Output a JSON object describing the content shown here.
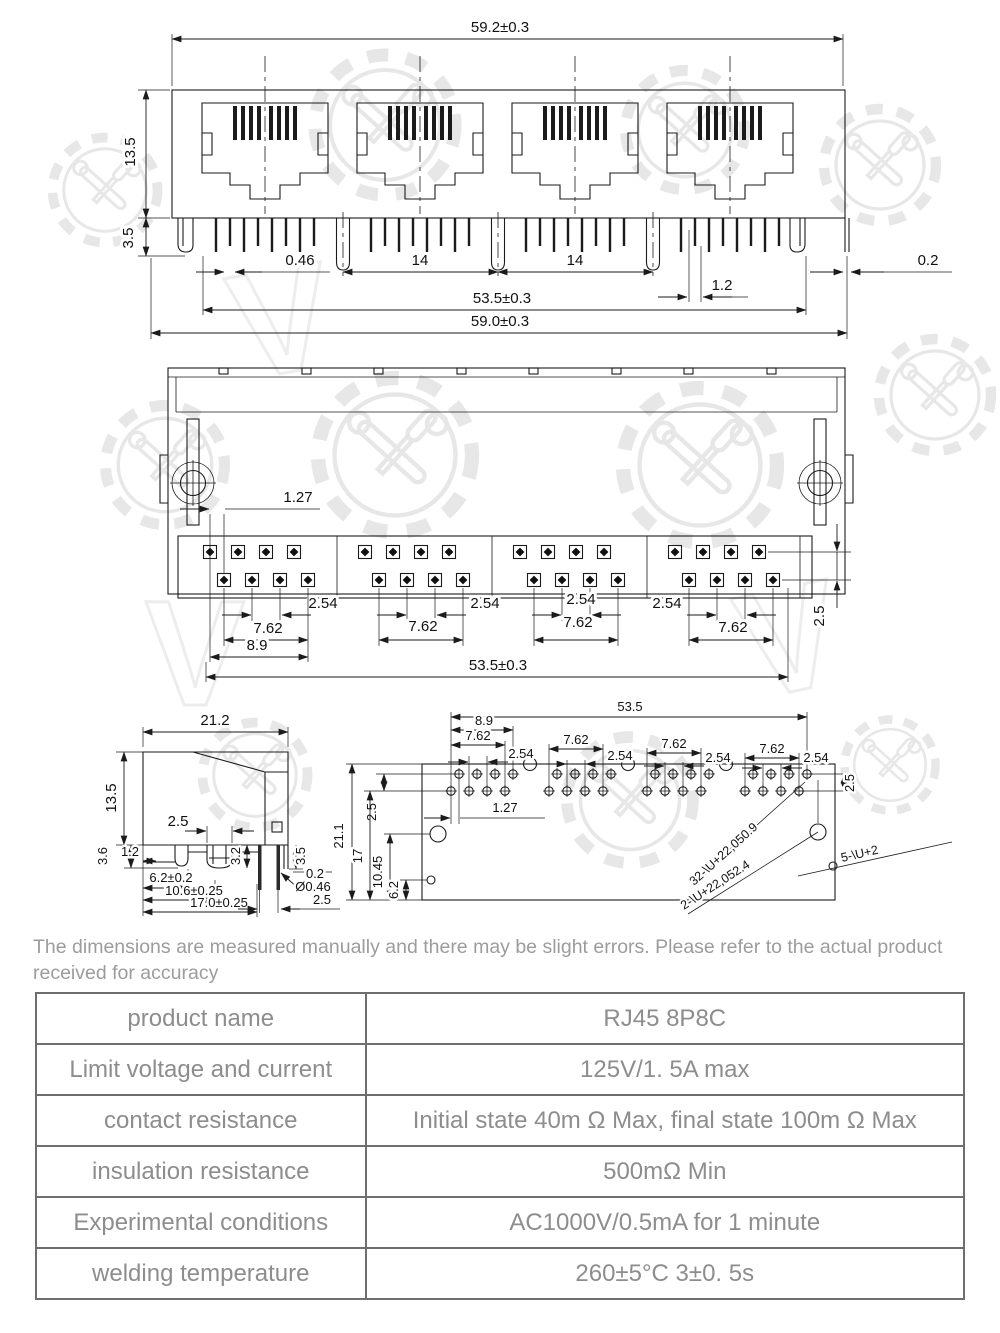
{
  "page": {
    "background": "#ffffff",
    "line_color": "#1b1b1b",
    "watermark_color": "#e7e7e7",
    "table_border_color": "#6e6e6e",
    "table_text_color": "#8d8d8d"
  },
  "watermark": {
    "logo": "gear-tools-logo",
    "letters": [
      "V",
      "V",
      "V",
      "V",
      "V"
    ]
  },
  "front_view": {
    "dims": {
      "overall_width": "59.2±0.3",
      "body_height": "13.5",
      "pin_length": "3.5",
      "pin_width": "0.46",
      "port_pitch_1": "14",
      "port_pitch_2": "14",
      "tab_offset": "1.2",
      "edge_gap": "0.2",
      "pin_span": "53.5±0.3",
      "bottom_width": "59.0±0.3"
    }
  },
  "top_view": {
    "dims": {
      "row_offset": "1.27",
      "pin_pitch": [
        "2.54",
        "2.54",
        "2.54",
        "2.54"
      ],
      "group_span": [
        "7.62",
        "7.62",
        "7.62",
        "7.62"
      ],
      "group_edge_span": "8.9",
      "pin_span": "53.5±0.3",
      "row_gap": "2.5"
    }
  },
  "side_view": {
    "dims": {
      "depth": "21.2",
      "height": "13.5",
      "post_width": "2.5",
      "leg_offset_a": "3.6",
      "leg_offset_b": "1.2",
      "post_depth": "3.2",
      "shield_leg": "3.5",
      "shield_gap": "0.2",
      "pin_pos_a": "6.2±0.2",
      "pin_pos_b": "10.6±0.25",
      "pin_pos_c": "17.0±0.25",
      "pin_dia": "Ø0.46",
      "leg_pitch": "2.5"
    }
  },
  "pcb_layout": {
    "dims": {
      "hole_span": "53.5",
      "edge_span": "8.9",
      "group_span": [
        "7.62",
        "7.62",
        "7.62",
        "7.62"
      ],
      "pin_pitch": [
        "2.54",
        "2.54",
        "2.54",
        "2.54"
      ],
      "row_gap": "2.5",
      "row_offset": "1.27",
      "board_depth": "21.1",
      "pos_row_gap": "2.5",
      "pos_row2": "17",
      "pos_post": "10.45",
      "pos_shield": "6.2"
    },
    "callouts": {
      "pin_holes": "32-\\U+22,050.9",
      "post_holes": "2-\\U+22,052.4",
      "shield_holes": "5-\\U+2"
    }
  },
  "note": {
    "text": "The dimensions are measured manually and there may be slight errors. Please refer to the actual product received for accuracy"
  },
  "spec_table": {
    "rows": [
      {
        "label": "product name",
        "value": "RJ45 8P8C"
      },
      {
        "label": "Limit voltage and current",
        "value": "125V/1. 5A max"
      },
      {
        "label": "contact resistance",
        "value": "Initial state 40m Ω Max, final state 100m Ω Max"
      },
      {
        "label": "insulation resistance",
        "value": "500mΩ Min"
      },
      {
        "label": "Experimental conditions",
        "value": "AC1000V/0.5mA for 1 minute"
      },
      {
        "label": "welding temperature",
        "value": "260±5°C 3±0. 5s"
      }
    ]
  }
}
